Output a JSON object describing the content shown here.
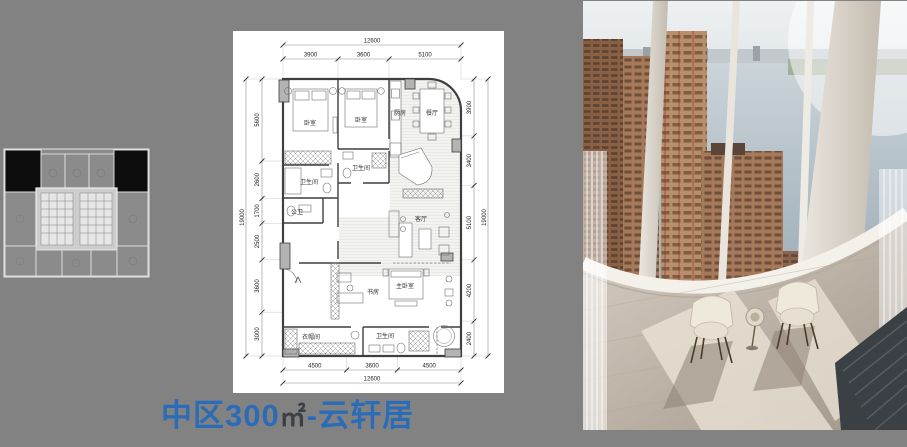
{
  "title": {
    "prefix": "中区300",
    "unit": "㎡",
    "suffix": "-云轩居"
  },
  "colors": {
    "page_background": "#828282",
    "title_blue": "#2b6cb8",
    "title_unit_dark": "#3b4046",
    "keyplan_highlight": "#0d0d0d",
    "plan_paper": "#ffffff"
  },
  "floor_plan": {
    "rooms": [
      "卧室",
      "卧室",
      "厨房",
      "餐厅",
      "卫生间",
      "卫生间",
      "公卫",
      "客厅",
      "书房",
      "主卧室",
      "衣帽间",
      "卫生间"
    ],
    "dims": {
      "top_overall": "12600",
      "top_segments": [
        "3900",
        "3600",
        "5100"
      ],
      "bottom_segments": [
        "4500",
        "3600",
        "4500"
      ],
      "bottom_overall": "12600",
      "left_overall": "19000",
      "left_segments": [
        "5600",
        "2600",
        "1700",
        "2500",
        "3600",
        "3000"
      ],
      "right_segments": [
        "3900",
        "3400",
        "5100",
        "4200",
        "2400"
      ],
      "right_overall": "19000"
    }
  }
}
